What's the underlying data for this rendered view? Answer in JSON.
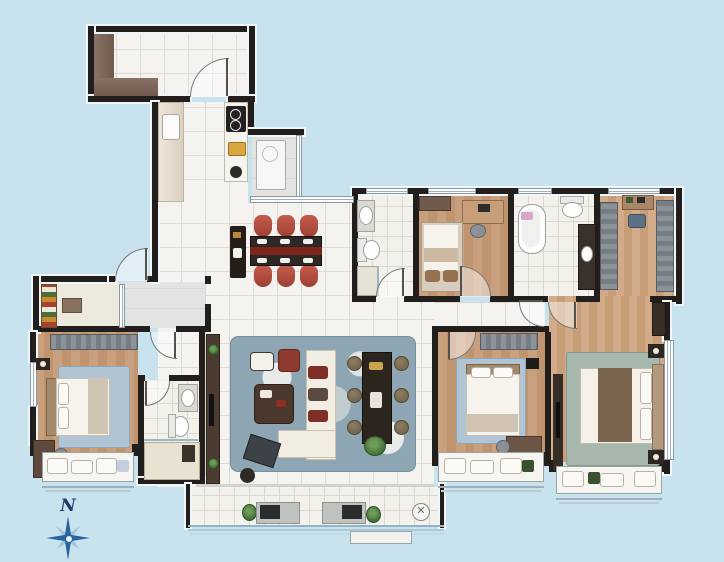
{
  "scene": {
    "kind": "residential-floor-plan",
    "view": "top-down-color-render"
  },
  "compass": {
    "label": "N"
  },
  "palette": {
    "background": "#c9e3ee",
    "wall": "#211e1b",
    "tile_floor": "#f4f3ef",
    "wood_floor": "#c9a07e",
    "gray_floor": "#e3e3e1",
    "living_rug": "#8ea6b4",
    "bedroom_rug": "#b0c4d3",
    "master_rug": "#a6b7ab",
    "dining_chair_red": "#b8503f",
    "table_runner_red": "#7d241b",
    "sofa_white": "#f2eee3",
    "wardrobe_gray": "#8b9298",
    "cabinet_brown": "#7d685a",
    "railing_blue": "#8fb7cb",
    "compass_blue": "#2a649f",
    "bathtub_towel_pink": "#d8a8ca"
  },
  "rooms": [
    {
      "id": "entry-foyer",
      "floor": "tile",
      "items": [
        "l-shaped-shoe-cabinet",
        "door-to-kitchen"
      ]
    },
    {
      "id": "kitchen",
      "floor": "tile",
      "items": [
        "counter-left",
        "sink",
        "counter-right",
        "cooktop-2-burner"
      ]
    },
    {
      "id": "utility-balcony",
      "floor": "gray-tile",
      "items": [
        "water-heater",
        "side-window"
      ]
    },
    {
      "id": "dining-room",
      "floor": "tile",
      "items": [
        "dining-table",
        "red-runner",
        "dining-chairs-x6",
        "sideboard"
      ]
    },
    {
      "id": "living-room",
      "floor": "tile",
      "items": [
        "area-rug",
        "sofa",
        "chaise",
        "coffee-table",
        "armchair-white",
        "armchair-red",
        "tea-table",
        "tea-stools-x6",
        "tv-cabinet",
        "floor-tv",
        "plant",
        "side-table"
      ]
    },
    {
      "id": "guest-bathroom",
      "floor": "tile",
      "items": [
        "vanity-sink",
        "toilet",
        "shower"
      ]
    },
    {
      "id": "bedroom-top",
      "floor": "wood",
      "items": [
        "wardrobe",
        "single-bed",
        "desk",
        "chair"
      ]
    },
    {
      "id": "master-bathroom",
      "floor": "tile",
      "items": [
        "freestanding-bathtub",
        "toilet",
        "vanity-counter"
      ]
    },
    {
      "id": "walk-in-closet",
      "floor": "wood",
      "items": [
        "wardrobe-left",
        "wardrobe-right",
        "dresser",
        "stool"
      ]
    },
    {
      "id": "master-bedroom",
      "floor": "wood",
      "items": [
        "double-bed",
        "headboard",
        "nightstand-x2",
        "tv-cabinet",
        "rug",
        "bay-window-seat",
        "side-window"
      ]
    },
    {
      "id": "bedroom-middle",
      "floor": "wood",
      "items": [
        "wardrobe",
        "bed",
        "rug",
        "desk",
        "wall-tv",
        "bay-window-seat"
      ]
    },
    {
      "id": "bedroom-left",
      "floor": "wood",
      "items": [
        "wardrobe",
        "bed",
        "rug",
        "desk",
        "nightstand",
        "bay-window-seat",
        "ensuite-door"
      ]
    },
    {
      "id": "ensuite-bathroom",
      "floor": "tile",
      "items": [
        "vanity-sink",
        "toilet",
        "shower",
        "niche-shelf"
      ]
    },
    {
      "id": "pantry-storage",
      "floor": "tile",
      "items": [
        "storage-shelf-colorful"
      ]
    },
    {
      "id": "entry-corridor",
      "floor": "gray-tile",
      "items": [
        "bifold-door",
        "entry-door"
      ]
    },
    {
      "id": "balcony",
      "floor": "tile",
      "items": [
        "desk-with-monitor-x2",
        "plants-x2",
        "floor-drain",
        "glass-railing",
        "step"
      ]
    }
  ]
}
